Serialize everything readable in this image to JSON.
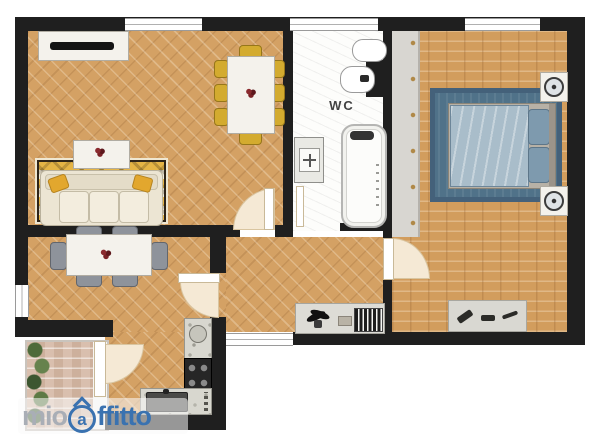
{
  "page": {
    "background": "#ffffff",
    "type": "apartment-floor-plan"
  },
  "labels": {
    "wc": "WC"
  },
  "watermark": {
    "mio": "mio",
    "a": "a",
    "ffitto": "ffitto",
    "mio_color": "#a9aeb6",
    "blue_color": "#3a72b0"
  },
  "palette": {
    "wall": "#1f1f1f",
    "parquet": "#d4a164",
    "bedroom_parquet": "#d29d5d",
    "marble_floor": "#fdfdfb",
    "rug_blue": "#507289",
    "rug_yellow": "#e5b445",
    "sofa_cream": "#ece5d3",
    "chair_gold": "#d3ab2f",
    "chair_gray": "#8e939b",
    "counter_gray": "#d8d7cf",
    "stove_black": "#262626",
    "plant_green": "#4e6b3a",
    "door_swing_beige": "#f5e9d5",
    "bed_blue": "#a9bdca"
  },
  "rooms": [
    {
      "name": "living-room",
      "floor": "herringbone parquet",
      "furniture": [
        "tv-console",
        "flat-tv",
        "dining-table",
        "8 gold chairs",
        "yellow patterned rug",
        "cream sofa with 2 yellow pillows",
        "coffee-table with flower centerpiece"
      ]
    },
    {
      "name": "bathroom",
      "label": "WC",
      "floor": "white marble",
      "fixtures": [
        "toilet",
        "bidet",
        "washbasin",
        "bathtub"
      ]
    },
    {
      "name": "bedroom",
      "floor": "straight parquet",
      "furniture": [
        "wardrobe",
        "blue area rug",
        "double bed with blue duvet",
        "2 nightstands with lamps",
        "low shelf with accessories"
      ]
    },
    {
      "name": "dining-room",
      "floor": "herringbone parquet",
      "furniture": [
        "white table with flower centerpiece",
        "6 gray chairs"
      ]
    },
    {
      "name": "hallway",
      "floor": "herringbone parquet",
      "furniture": [
        "console with plant, trinkets and book row"
      ]
    },
    {
      "name": "kitchen",
      "floor": "herringbone parquet",
      "furniture": [
        "counter with dishes",
        "4-burner stove",
        "sink base unit with knobs"
      ]
    },
    {
      "name": "balcony",
      "floor": "brick tiles",
      "furniture": [
        "row of plants"
      ]
    }
  ],
  "openings": {
    "windows": 5,
    "interior_doors": 5
  }
}
